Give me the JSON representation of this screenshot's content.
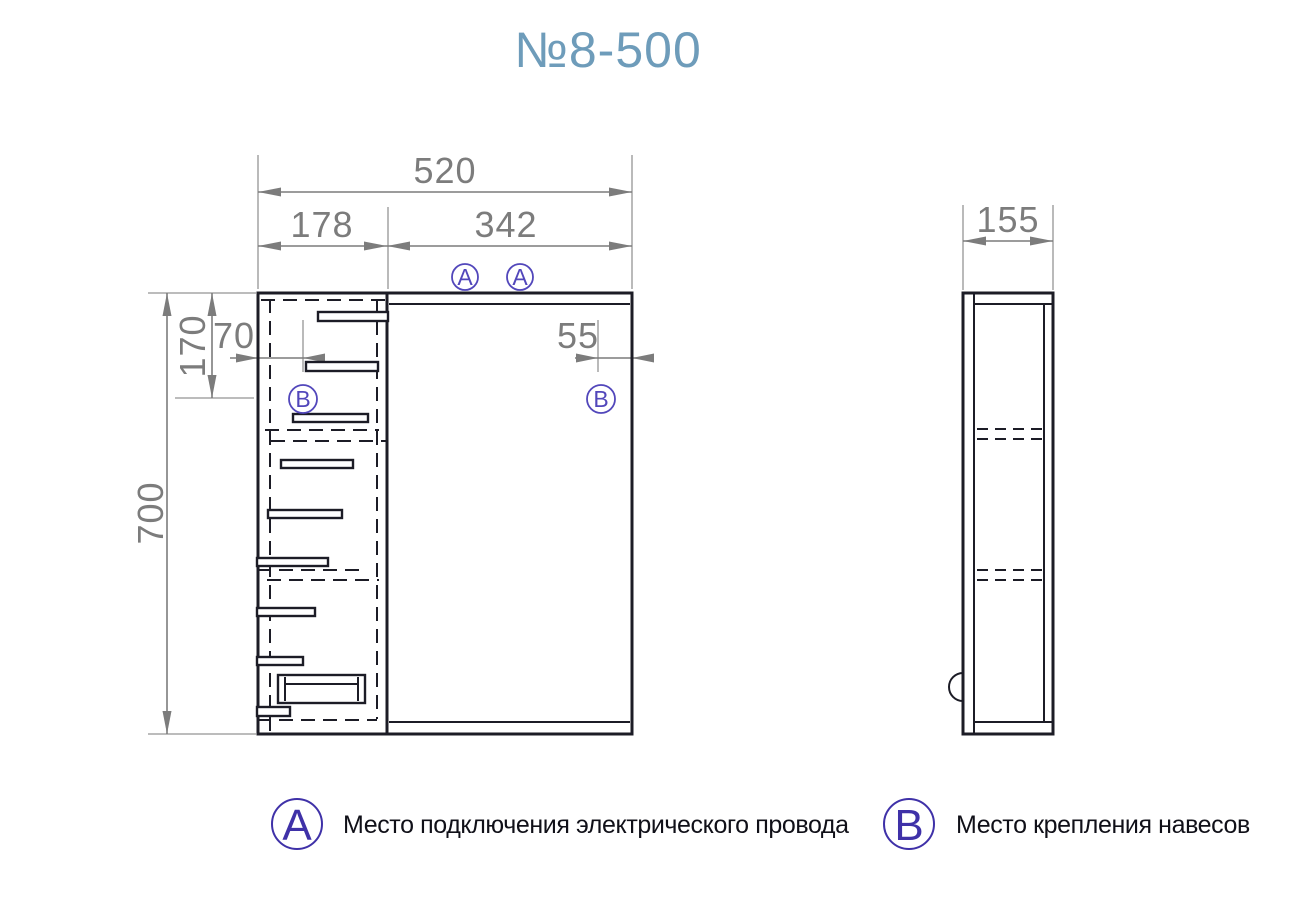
{
  "title": "№8-500",
  "colors": {
    "title": "#6e9cba",
    "drawing_line": "#1c1c26",
    "dimension": "#7c7c7c",
    "marker": "#5247bb",
    "legend_marker": "#3f31a8",
    "background": "#ffffff"
  },
  "front_view": {
    "dim_total_width": "520",
    "dim_left_width": "178",
    "dim_right_width": "342",
    "dim_total_height": "700",
    "dim_hanger_from_top": "170",
    "dim_hanger_from_left": "70",
    "dim_hanger_from_right": "55"
  },
  "side_view": {
    "dim_depth": "155"
  },
  "markers": {
    "electric": "A",
    "hanger": "B"
  },
  "legend": {
    "electric": {
      "letter": "A",
      "label": "Место подключения электрического провода"
    },
    "hanger": {
      "letter": "B",
      "label": "Место крепления навесов"
    }
  }
}
